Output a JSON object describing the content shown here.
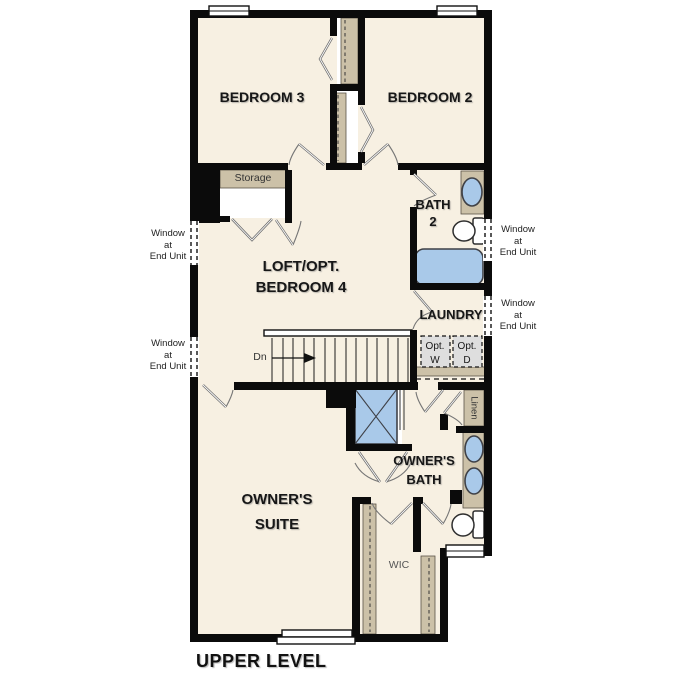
{
  "title": "UPPER LEVEL",
  "rooms": {
    "bedroom3": "BEDROOM 3",
    "bedroom2": "BEDROOM 2",
    "loft": {
      "line1": "LOFT/OPT.",
      "line2": "BEDROOM 4"
    },
    "bath2": {
      "line1": "BATH",
      "line2": "2"
    },
    "laundry": "LAUNDRY",
    "owners_suite": {
      "line1": "OWNER'S",
      "line2": "SUITE"
    },
    "owners_bath": {
      "line1": "OWNER'S",
      "line2": "BATH"
    },
    "wic": "WIC"
  },
  "closets": {
    "storage": "Storage",
    "linen": "Linen"
  },
  "appliances": {
    "washer": {
      "line1": "Opt.",
      "line2": "W"
    },
    "dryer": {
      "line1": "Opt.",
      "line2": "D"
    }
  },
  "stairs": {
    "direction": "Dn"
  },
  "notes": {
    "window_end_unit": {
      "line1": "Window",
      "line2": "at",
      "line3": "End Unit"
    }
  },
  "colors": {
    "background": "#FFFFFF",
    "floor": "#F7F0E2",
    "wall": "#0B0B0B",
    "wood": "#CCC1A8",
    "fixture_blue": "#A9C9E9",
    "appliance_gray": "#DEDEDE"
  }
}
